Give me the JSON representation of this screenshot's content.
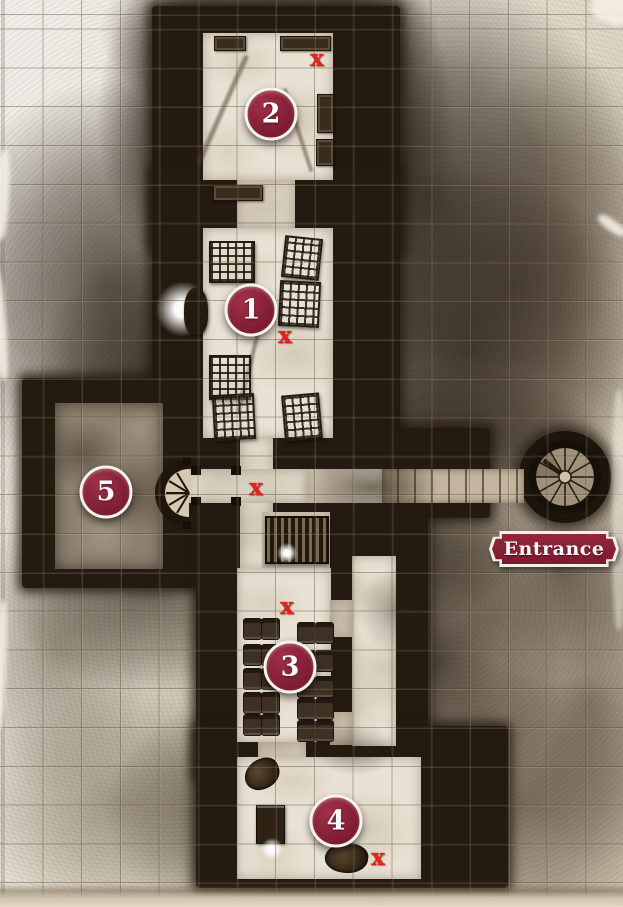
{
  "map": {
    "entrance_label": "Entrance",
    "markers": [
      {
        "id": "marker-1",
        "label": "1",
        "x": 251,
        "y": 310
      },
      {
        "id": "marker-2",
        "label": "2",
        "x": 271,
        "y": 114
      },
      {
        "id": "marker-3",
        "label": "3",
        "x": 290,
        "y": 667
      },
      {
        "id": "marker-4",
        "label": "4",
        "x": 336,
        "y": 821
      },
      {
        "id": "marker-5",
        "label": "5",
        "x": 106,
        "y": 492
      }
    ],
    "x_marks": [
      {
        "id": "x-room-2",
        "label": "x",
        "x": 317,
        "y": 59
      },
      {
        "id": "x-room-1",
        "label": "x",
        "x": 285,
        "y": 336
      },
      {
        "id": "x-junction",
        "label": "x",
        "x": 256,
        "y": 488
      },
      {
        "id": "x-room-3",
        "label": "x",
        "x": 287,
        "y": 607
      },
      {
        "id": "x-room-4",
        "label": "x",
        "x": 378,
        "y": 858
      }
    ],
    "colors": {
      "marker_fill": "#87213a",
      "marker_border": "#ffffff",
      "x_mark": "#e6221a",
      "banner_fill": "#87213a",
      "banner_text": "#ffffff",
      "wall_ink": "#241a10",
      "floor_light": "#e9e2d4",
      "floor_stone": "#8d8170",
      "parchment": "#efece6"
    },
    "features": [
      {
        "type": "streak",
        "x": 220,
        "y": 50,
        "w": 5,
        "h": 120,
        "rot": 24
      },
      {
        "type": "streak",
        "x": 296,
        "y": 86,
        "w": 4,
        "h": 88,
        "rot": -18
      },
      {
        "type": "streak",
        "x": 250,
        "y": 298,
        "w": 4,
        "h": 118,
        "rot": 14
      },
      {
        "type": "crate",
        "x": 214,
        "y": 36,
        "w": 30,
        "h": 13,
        "rot": 0
      },
      {
        "type": "crate",
        "x": 280,
        "y": 36,
        "w": 49,
        "h": 13,
        "rot": 0
      },
      {
        "type": "crate",
        "x": 317,
        "y": 94,
        "w": 15,
        "h": 37,
        "rot": 0
      },
      {
        "type": "crate",
        "x": 316,
        "y": 139,
        "w": 16,
        "h": 25,
        "rot": 0
      },
      {
        "type": "table",
        "x": 213,
        "y": 185,
        "w": 48,
        "h": 14,
        "rot": 0
      },
      {
        "type": "cage",
        "x": 209,
        "y": 241,
        "w": 42,
        "h": 38,
        "rot": 0
      },
      {
        "type": "cage",
        "x": 283,
        "y": 237,
        "w": 34,
        "h": 38,
        "rot": 6
      },
      {
        "type": "cage",
        "x": 279,
        "y": 281,
        "w": 37,
        "h": 42,
        "rot": 3
      },
      {
        "type": "cage",
        "x": 209,
        "y": 355,
        "w": 38,
        "h": 41,
        "rot": 0
      },
      {
        "type": "cage",
        "x": 213,
        "y": 394,
        "w": 38,
        "h": 42,
        "rot": -3
      },
      {
        "type": "cage",
        "x": 283,
        "y": 394,
        "w": 34,
        "h": 42,
        "rot": -5
      },
      {
        "type": "glow",
        "x": 156,
        "y": 282,
        "w": 54,
        "h": 54,
        "rot": 0
      },
      {
        "type": "statue",
        "x": 184,
        "y": 288,
        "w": 24,
        "h": 47,
        "rot": 0
      },
      {
        "type": "door",
        "x": 191,
        "y": 466,
        "w": 10,
        "h": 9,
        "rot": 0
      },
      {
        "type": "door",
        "x": 191,
        "y": 497,
        "w": 10,
        "h": 9,
        "rot": 0
      },
      {
        "type": "door",
        "x": 231,
        "y": 466,
        "w": 10,
        "h": 9,
        "rot": 0
      },
      {
        "type": "door",
        "x": 231,
        "y": 497,
        "w": 10,
        "h": 9,
        "rot": 0
      },
      {
        "type": "altar",
        "x": 265,
        "y": 516,
        "w": 60,
        "h": 44,
        "rot": 0
      },
      {
        "type": "orb",
        "x": 277,
        "y": 543,
        "w": 20,
        "h": 20,
        "rot": 0
      },
      {
        "type": "pew",
        "x": 243,
        "y": 618,
        "w": 17,
        "h": 20,
        "rot": 0
      },
      {
        "type": "pew",
        "x": 261,
        "y": 618,
        "w": 17,
        "h": 20,
        "rot": 0
      },
      {
        "type": "pew",
        "x": 243,
        "y": 644,
        "w": 17,
        "h": 20,
        "rot": 0
      },
      {
        "type": "pew",
        "x": 261,
        "y": 644,
        "w": 17,
        "h": 20,
        "rot": 0
      },
      {
        "type": "pew",
        "x": 243,
        "y": 668,
        "w": 17,
        "h": 20,
        "rot": 0
      },
      {
        "type": "pew",
        "x": 261,
        "y": 668,
        "w": 17,
        "h": 20,
        "rot": 0
      },
      {
        "type": "pew",
        "x": 243,
        "y": 692,
        "w": 17,
        "h": 20,
        "rot": 0
      },
      {
        "type": "pew",
        "x": 261,
        "y": 692,
        "w": 17,
        "h": 20,
        "rot": 0
      },
      {
        "type": "pew",
        "x": 243,
        "y": 714,
        "w": 17,
        "h": 20,
        "rot": 0
      },
      {
        "type": "pew",
        "x": 261,
        "y": 714,
        "w": 17,
        "h": 20,
        "rot": 0
      },
      {
        "type": "pew",
        "x": 297,
        "y": 622,
        "w": 17,
        "h": 20,
        "rot": 0
      },
      {
        "type": "pew",
        "x": 315,
        "y": 622,
        "w": 17,
        "h": 20,
        "rot": 0
      },
      {
        "type": "pew",
        "x": 297,
        "y": 650,
        "w": 17,
        "h": 20,
        "rot": 0
      },
      {
        "type": "pew",
        "x": 315,
        "y": 650,
        "w": 17,
        "h": 20,
        "rot": 0
      },
      {
        "type": "pew",
        "x": 297,
        "y": 676,
        "w": 17,
        "h": 20,
        "rot": 0
      },
      {
        "type": "pew",
        "x": 315,
        "y": 676,
        "w": 17,
        "h": 20,
        "rot": 0
      },
      {
        "type": "pew",
        "x": 297,
        "y": 698,
        "w": 17,
        "h": 20,
        "rot": 0
      },
      {
        "type": "pew",
        "x": 315,
        "y": 698,
        "w": 17,
        "h": 20,
        "rot": 0
      },
      {
        "type": "pew",
        "x": 297,
        "y": 720,
        "w": 17,
        "h": 20,
        "rot": 0
      },
      {
        "type": "pew",
        "x": 315,
        "y": 720,
        "w": 17,
        "h": 20,
        "rot": 0
      },
      {
        "type": "skeleton",
        "x": 244,
        "y": 759,
        "w": 36,
        "h": 30,
        "rot": -20
      },
      {
        "type": "chest",
        "x": 256,
        "y": 805,
        "w": 27,
        "h": 37,
        "rot": 0
      },
      {
        "type": "orb",
        "x": 261,
        "y": 838,
        "w": 22,
        "h": 22,
        "rot": 0
      },
      {
        "type": "skeleton",
        "x": 325,
        "y": 843,
        "w": 43,
        "h": 30,
        "rot": 8
      }
    ]
  }
}
